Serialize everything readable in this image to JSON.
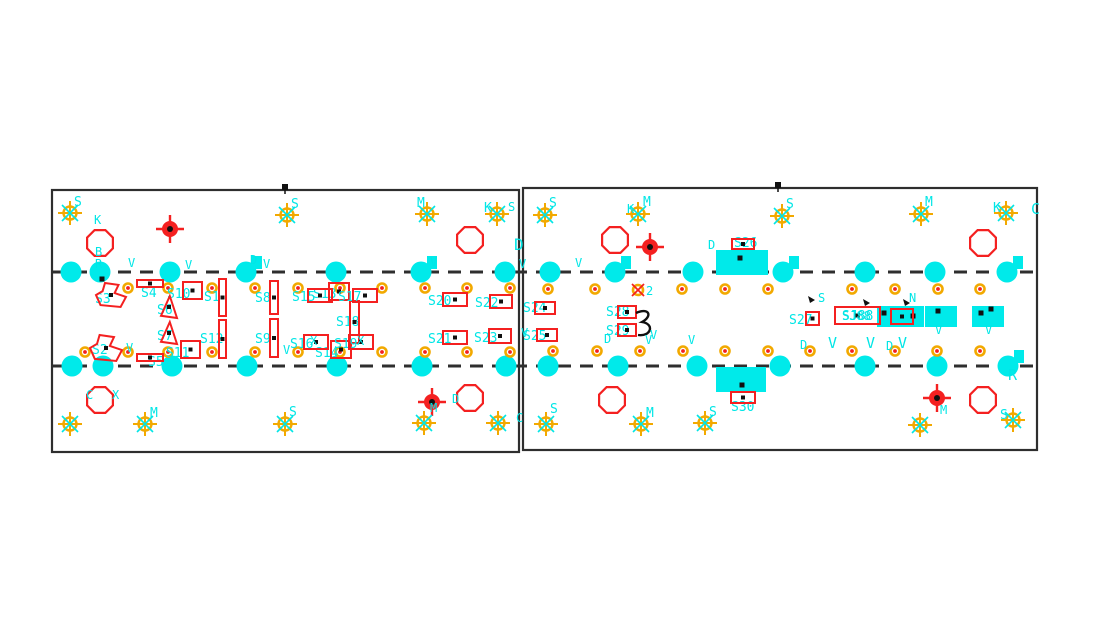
{
  "drawing": {
    "title": "pcb-panel-assembly-drawing",
    "canvas": {
      "width": 1099,
      "height": 631,
      "bg": "#ffffff"
    },
    "colors": {
      "cyan": "#00e6e6",
      "cyan_fill": "#00eaea",
      "red": "#f42020",
      "gold": "#f2a900",
      "dark": "#2e2e2e",
      "black": "#101010",
      "white": "#ffffff"
    },
    "panels": [
      {
        "x": 52,
        "y": 190,
        "w": 467,
        "h": 262
      },
      {
        "x": 523,
        "y": 188,
        "w": 514,
        "h": 262
      }
    ],
    "dashed_lines": [
      {
        "x1": 52,
        "y": 272,
        "x2": 1037
      },
      {
        "x1": 52,
        "y": 366,
        "x2": 1037
      }
    ],
    "holes": {
      "r": 10.5,
      "rows": [
        {
          "y": 272,
          "xs": [
            71,
            100,
            170,
            246,
            336,
            421,
            505,
            550,
            615,
            693,
            783,
            865,
            935,
            1007
          ]
        },
        {
          "y": 366,
          "xs": [
            72,
            103,
            172,
            247,
            337,
            422,
            506,
            548,
            618,
            697,
            780,
            865,
            937,
            1008
          ]
        }
      ],
      "tabs": [
        {
          "x": 246,
          "y": 272
        },
        {
          "x": 421,
          "y": 272
        },
        {
          "x": 615,
          "y": 272
        },
        {
          "x": 783,
          "y": 272
        },
        {
          "x": 1007,
          "y": 272
        },
        {
          "x": 1008,
          "y": 366
        }
      ],
      "dots": [
        {
          "x": 102,
          "y": 279
        }
      ]
    },
    "octagons": {
      "r": 14,
      "points": [
        {
          "x": 100,
          "y": 243
        },
        {
          "x": 470,
          "y": 240
        },
        {
          "x": 100,
          "y": 400
        },
        {
          "x": 470,
          "y": 398
        },
        {
          "x": 615,
          "y": 240
        },
        {
          "x": 983,
          "y": 243
        },
        {
          "x": 612,
          "y": 400
        },
        {
          "x": 983,
          "y": 400
        }
      ]
    },
    "fiducials": [
      {
        "x": 170,
        "y": 229
      },
      {
        "x": 432,
        "y": 402
      },
      {
        "x": 650,
        "y": 247
      },
      {
        "x": 937,
        "y": 398
      }
    ],
    "targets": [
      {
        "x": 70,
        "y": 213,
        "t": "S",
        "tx": 74,
        "ty": 206
      },
      {
        "x": 287,
        "y": 215,
        "t": "S",
        "tx": 291,
        "ty": 208
      },
      {
        "x": 427,
        "y": 214,
        "t": "M",
        "tx": 417,
        "ty": 207
      },
      {
        "x": 497,
        "y": 214,
        "t": "K",
        "tx": 484,
        "ty": 212
      },
      {
        "x": 545,
        "y": 215,
        "t": "S",
        "tx": 549,
        "ty": 207
      },
      {
        "x": 638,
        "y": 214,
        "t": "M",
        "tx": 643,
        "ty": 206
      },
      {
        "x": 782,
        "y": 216,
        "t": "S",
        "tx": 786,
        "ty": 208
      },
      {
        "x": 921,
        "y": 214,
        "t": "M",
        "tx": 925,
        "ty": 206
      },
      {
        "x": 1006,
        "y": 213,
        "t": "K",
        "tx": 993,
        "ty": 212
      },
      {
        "x": 70,
        "y": 424,
        "t": "",
        "tx": 0,
        "ty": 0
      },
      {
        "x": 145,
        "y": 424,
        "t": "M",
        "tx": 150,
        "ty": 417
      },
      {
        "x": 285,
        "y": 424,
        "t": "S",
        "tx": 289,
        "ty": 416
      },
      {
        "x": 424,
        "y": 423,
        "t": "",
        "tx": 0,
        "ty": 0
      },
      {
        "x": 498,
        "y": 423,
        "t": "",
        "tx": 0,
        "ty": 0
      },
      {
        "x": 546,
        "y": 424,
        "t": "S",
        "tx": 550,
        "ty": 413
      },
      {
        "x": 641,
        "y": 424,
        "t": "M",
        "tx": 646,
        "ty": 417
      },
      {
        "x": 705,
        "y": 423,
        "t": "S",
        "tx": 709,
        "ty": 416
      },
      {
        "x": 920,
        "y": 425,
        "t": "",
        "tx": 0,
        "ty": 0
      },
      {
        "x": 1013,
        "y": 420,
        "t": "S",
        "tx": 1000,
        "ty": 419
      }
    ],
    "pads": {
      "r": 4.5,
      "rows": [
        {
          "y": 288,
          "xs": [
            128,
            168,
            212,
            255,
            298,
            340,
            382,
            425,
            467,
            510
          ]
        },
        {
          "y": 352,
          "xs": [
            85,
            128,
            168,
            212,
            255,
            298,
            340,
            382,
            425,
            467,
            510
          ]
        },
        {
          "y": 289,
          "xs": [
            548,
            595,
            682,
            725,
            768,
            852,
            895,
            938,
            980
          ]
        },
        {
          "y": 351,
          "xs": [
            553,
            597,
            640,
            683,
            725,
            768,
            810,
            852,
            895,
            937,
            980
          ]
        }
      ],
      "star": {
        "x": 638,
        "y": 290,
        "label": "2"
      }
    },
    "components": [
      {
        "type": "blob",
        "x": 96,
        "y": 283,
        "w": 30,
        "h": 24,
        "label": "S3",
        "lx": 95,
        "ly": 303
      },
      {
        "type": "blob",
        "x": 90,
        "y": 335,
        "w": 32,
        "h": 26,
        "label": "S2",
        "lx": 92,
        "ly": 354
      },
      {
        "type": "hbar",
        "x": 137,
        "y": 280,
        "w": 26,
        "h": 7,
        "label": "S4",
        "lx": 141,
        "ly": 297
      },
      {
        "type": "hbar",
        "x": 137,
        "y": 354,
        "w": 26,
        "h": 7,
        "label": "S5",
        "lx": 148,
        "ly": 366
      },
      {
        "type": "rect",
        "x": 183,
        "y": 282,
        "w": 19,
        "h": 17,
        "label": "S10",
        "lx": 167,
        "ly": 298
      },
      {
        "type": "rect",
        "x": 181,
        "y": 341,
        "w": 19,
        "h": 17,
        "label": "S11",
        "lx": 166,
        "ly": 357
      },
      {
        "type": "tri",
        "x": 161,
        "y": 296,
        "w": 16,
        "h": 22,
        "label": "S6",
        "lx": 157,
        "ly": 314
      },
      {
        "type": "tri",
        "x": 161,
        "y": 322,
        "w": 16,
        "h": 22,
        "label": "S7",
        "lx": 157,
        "ly": 340
      },
      {
        "type": "vbar",
        "x": 219,
        "y": 279,
        "w": 7,
        "h": 37,
        "label": "S1",
        "lx": 204,
        "ly": 301
      },
      {
        "type": "vbar",
        "x": 219,
        "y": 320,
        "w": 7,
        "h": 38,
        "label": "S12",
        "lx": 200,
        "ly": 343
      },
      {
        "type": "vbar",
        "x": 270,
        "y": 281,
        "w": 8,
        "h": 33,
        "label": "S8",
        "lx": 255,
        "ly": 302
      },
      {
        "type": "vbar",
        "x": 270,
        "y": 319,
        "w": 8,
        "h": 38,
        "label": "S9",
        "lx": 255,
        "ly": 343
      },
      {
        "type": "rect",
        "x": 329,
        "y": 283,
        "w": 20,
        "h": 17,
        "label": "S13",
        "lx": 313,
        "ly": 298
      },
      {
        "type": "vbar",
        "x": 350,
        "y": 301,
        "w": 9,
        "h": 42,
        "label": "S18",
        "lx": 336,
        "ly": 326
      },
      {
        "type": "rect",
        "x": 331,
        "y": 341,
        "w": 20,
        "h": 17,
        "label": "S14",
        "lx": 315,
        "ly": 357
      },
      {
        "type": "res",
        "x": 308,
        "y": 289,
        "w": 24,
        "h": 13,
        "label": "S15",
        "lx": 292,
        "ly": 301
      },
      {
        "type": "res",
        "x": 353,
        "y": 289,
        "w": 24,
        "h": 13,
        "label": "S17",
        "lx": 338,
        "ly": 301
      },
      {
        "type": "res",
        "x": 443,
        "y": 293,
        "w": 24,
        "h": 13,
        "label": "S20",
        "lx": 428,
        "ly": 305
      },
      {
        "type": "res",
        "x": 490,
        "y": 295,
        "w": 22,
        "h": 13,
        "label": "S22",
        "lx": 475,
        "ly": 307
      },
      {
        "type": "res",
        "x": 304,
        "y": 335,
        "w": 24,
        "h": 14,
        "label": "S16",
        "lx": 290,
        "ly": 348
      },
      {
        "type": "res",
        "x": 349,
        "y": 335,
        "w": 24,
        "h": 14,
        "label": "S19",
        "lx": 334,
        "ly": 348
      },
      {
        "type": "res",
        "x": 443,
        "y": 331,
        "w": 24,
        "h": 13,
        "label": "S21",
        "lx": 428,
        "ly": 343
      },
      {
        "type": "res",
        "x": 489,
        "y": 329,
        "w": 22,
        "h": 14,
        "label": "S23",
        "lx": 474,
        "ly": 342
      },
      {
        "type": "res",
        "x": 535,
        "y": 302,
        "w": 20,
        "h": 12,
        "label": "S24",
        "lx": 523,
        "ly": 312
      },
      {
        "type": "res",
        "x": 537,
        "y": 329,
        "w": 20,
        "h": 12,
        "label": "S25",
        "lx": 523,
        "ly": 340
      },
      {
        "type": "res",
        "x": 618,
        "y": 306,
        "w": 18,
        "h": 12,
        "label": "S28",
        "lx": 606,
        "ly": 316
      },
      {
        "type": "res",
        "x": 618,
        "y": 324,
        "w": 18,
        "h": 12,
        "label": "S29",
        "lx": 606,
        "ly": 335
      },
      {
        "type": "res",
        "x": 732,
        "y": 239,
        "w": 22,
        "h": 10,
        "label": "S26",
        "lx": 734,
        "ly": 247
      },
      {
        "type": "res",
        "x": 731,
        "y": 392,
        "w": 24,
        "h": 11,
        "label": "S30",
        "lx": 731,
        "ly": 411
      },
      {
        "type": "rect",
        "x": 806,
        "y": 312,
        "w": 13,
        "h": 13,
        "label": "S27",
        "lx": 789,
        "ly": 324
      },
      {
        "type": "jumper",
        "x": 835,
        "y": 307,
        "w": 45,
        "h": 17,
        "label": "SJ88",
        "lx": 842,
        "ly": 320
      },
      {
        "type": "res",
        "x": 891,
        "y": 309,
        "w": 22,
        "h": 15,
        "label": "",
        "lx": 0,
        "ly": 0
      }
    ],
    "cyan_parts": [
      {
        "x": 716,
        "y": 250,
        "w": 52,
        "h": 25,
        "dots": [
          [
            740,
            258
          ]
        ]
      },
      {
        "x": 716,
        "y": 367,
        "w": 50,
        "h": 25,
        "dots": [
          [
            742,
            385
          ]
        ]
      },
      {
        "x": 877,
        "y": 306,
        "w": 47,
        "h": 21,
        "dots": [
          [
            884,
            313
          ],
          [
            913,
            316
          ]
        ]
      },
      {
        "x": 925,
        "y": 306,
        "w": 32,
        "h": 21,
        "dots": [
          [
            938,
            311
          ]
        ]
      },
      {
        "x": 972,
        "y": 306,
        "w": 32,
        "h": 21,
        "dots": [
          [
            981,
            313
          ],
          [
            991,
            309
          ]
        ]
      }
    ],
    "bracket": {
      "x": 636,
      "y": 311
    },
    "letters": [
      {
        "t": "K",
        "x": 94,
        "y": 224
      },
      {
        "t": "B",
        "x": 95,
        "y": 256
      },
      {
        "t": "R",
        "x": 95,
        "y": 268
      },
      {
        "t": "S",
        "x": 508,
        "y": 211
      },
      {
        "t": "K",
        "x": 627,
        "y": 213
      },
      {
        "t": "C",
        "x": 1031,
        "y": 214,
        "s": 15
      },
      {
        "t": "D",
        "x": 514,
        "y": 250,
        "s": 16
      },
      {
        "t": "D",
        "x": 708,
        "y": 249
      },
      {
        "t": "V",
        "x": 128,
        "y": 267
      },
      {
        "t": "V",
        "x": 185,
        "y": 269
      },
      {
        "t": "D",
        "x": 250,
        "y": 264
      },
      {
        "t": "V",
        "x": 263,
        "y": 268
      },
      {
        "t": "V",
        "x": 430,
        "y": 266
      },
      {
        "t": "V",
        "x": 519,
        "y": 268
      },
      {
        "t": "V",
        "x": 575,
        "y": 267
      },
      {
        "t": "V",
        "x": 126,
        "y": 352
      },
      {
        "t": "X",
        "x": 310,
        "y": 345
      },
      {
        "t": "X",
        "x": 357,
        "y": 345
      },
      {
        "t": "V",
        "x": 283,
        "y": 354
      },
      {
        "t": "M",
        "x": 430,
        "y": 412
      },
      {
        "t": "D",
        "x": 452,
        "y": 403
      },
      {
        "t": "C",
        "x": 516,
        "y": 422
      },
      {
        "t": "C",
        "x": 86,
        "y": 399
      },
      {
        "t": "X",
        "x": 112,
        "y": 399
      },
      {
        "t": "R",
        "x": 1008,
        "y": 380,
        "s": 15
      },
      {
        "t": "M",
        "x": 940,
        "y": 414
      },
      {
        "t": "N",
        "x": 909,
        "y": 302
      },
      {
        "t": "S",
        "x": 818,
        "y": 302
      },
      {
        "t": "V",
        "x": 828,
        "y": 348,
        "s": 15
      },
      {
        "t": "V",
        "x": 866,
        "y": 348,
        "s": 15
      },
      {
        "t": "V",
        "x": 898,
        "y": 348,
        "s": 15
      },
      {
        "t": "D",
        "x": 800,
        "y": 349
      },
      {
        "t": "D",
        "x": 886,
        "y": 350
      },
      {
        "t": "V",
        "x": 650,
        "y": 339
      },
      {
        "t": "V",
        "x": 521,
        "y": 337
      },
      {
        "t": "D",
        "x": 604,
        "y": 343
      },
      {
        "t": "V",
        "x": 645,
        "y": 344
      },
      {
        "t": "V",
        "x": 688,
        "y": 344
      },
      {
        "t": "V",
        "x": 935,
        "y": 334
      },
      {
        "t": "V",
        "x": 985,
        "y": 334
      }
    ],
    "datum_marks": [
      {
        "x": 285,
        "y": 188
      },
      {
        "x": 778,
        "y": 186
      }
    ],
    "black_arrows": [
      {
        "x": 808,
        "y": 296
      },
      {
        "x": 863,
        "y": 299
      },
      {
        "x": 903,
        "y": 299
      }
    ]
  }
}
